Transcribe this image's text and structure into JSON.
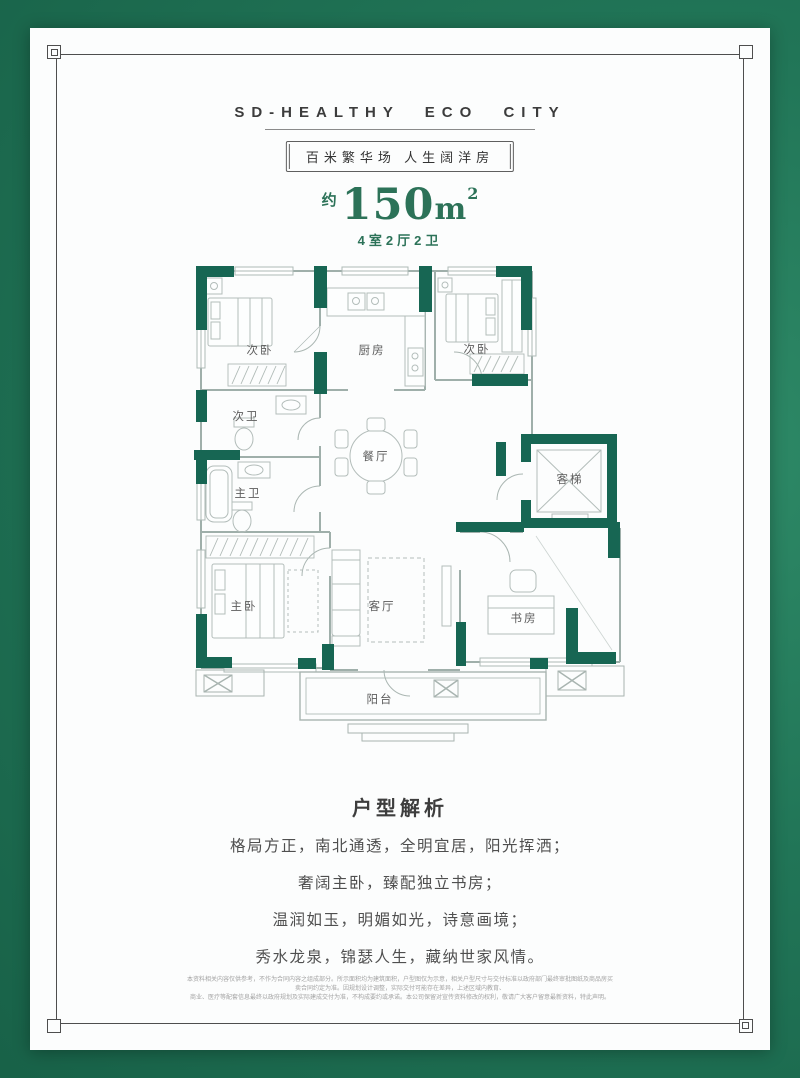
{
  "poster": {
    "bg_green": "#217557",
    "wall_green": "#176653",
    "title_green": "#2c7258"
  },
  "header": {
    "brand": "SD-HEALTHY ECO CITY",
    "slogan": "百米繁华场  人生阔洋房"
  },
  "unit": {
    "approx": "约",
    "area": "150",
    "unit": "m",
    "unit_sup": "2",
    "rooms_summary": "4室2厅2卫"
  },
  "floorplan": {
    "rooms": [
      {
        "label": "次卧"
      },
      {
        "label": "厨房"
      },
      {
        "label": "次卧"
      },
      {
        "label": "次卫"
      },
      {
        "label": "餐厅"
      },
      {
        "label": "客梯"
      },
      {
        "label": "主卫"
      },
      {
        "label": "主卧"
      },
      {
        "label": "客厅"
      },
      {
        "label": "书房"
      },
      {
        "label": "阳台"
      }
    ]
  },
  "analysis": {
    "title": "户型解析",
    "lines": [
      "格局方正，南北通透，全明宜居，阳光挥洒；",
      "奢阔主卧，臻配独立书房；",
      "温润如玉，明媚如光，诗意画境；",
      "秀水龙泉，锦瑟人生，藏纳世家风情。"
    ]
  },
  "disclaimer": {
    "line1": "本资料相关内容仅供参考，不作为合同内容之组成部分。所示面积均为建筑面积，户型图仅为示意，相关户型尺寸与交付标准以政府部门最终审批图纸及商品房买卖合同约定为准。因规划设计调整，实际交付可能存在差异，上述区域内教育、",
    "line2": "商业、医疗等配套信息最终以政府规划及实际建成交付为准，不构成要约或承诺。本公司保留对宣传资料修改的权利，敬请广大客户留意最新资料，特此声明。"
  }
}
